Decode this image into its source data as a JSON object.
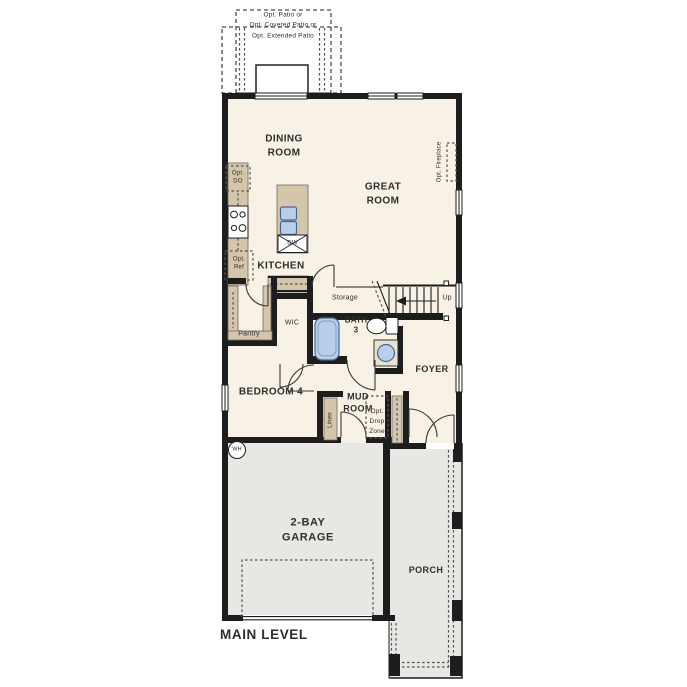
{
  "plan_title": "MAIN LEVEL",
  "labels": {
    "patio": "Opt. Patio or\nOpt. Covered Patio or\nOpt. Extended Patio",
    "dining": "DINING\nROOM",
    "great": "GREAT\nROOM",
    "kitchen": "KITCHEN",
    "opt_do": "Opt.\nDO",
    "opt_ref": "Opt.\nRef",
    "opt_fireplace": "Opt. Fireplace",
    "dw": "DW",
    "storage": "Storage",
    "up": "Up",
    "pantry": "Pantry",
    "wic": "WIC",
    "bath3": "BATH\n3",
    "foyer": "FOYER",
    "bedroom4": "BEDROOM 4",
    "mud": "MUD\nROOM",
    "drop_zone": "Opt.\nDrop\nZone",
    "linen": "Linen",
    "wh": "WH",
    "garage": "2-BAY\nGARAGE",
    "porch": "PORCH",
    "main_level": "MAIN LEVEL"
  },
  "colors": {
    "wall": "#1d1d1d",
    "floor": "#f8f1e5",
    "hard": "#e8e7e3",
    "cab": "#d4c6aa",
    "fix": "#b7cfe9",
    "text": "#2e2e2e"
  }
}
